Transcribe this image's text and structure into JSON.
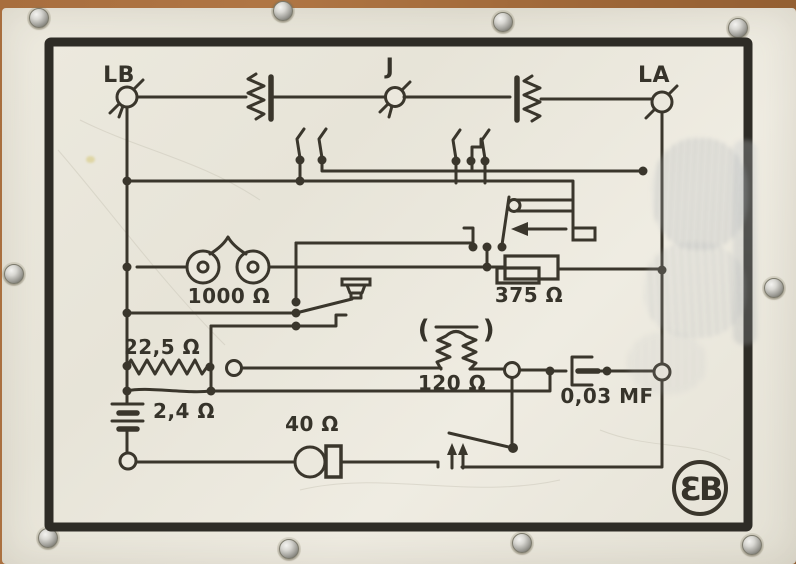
{
  "labels": {
    "terminal_lb": "LB",
    "terminal_j": "J",
    "terminal_la": "LA",
    "ringer_1000": "1000 Ω",
    "resistor_375": "375 Ω",
    "resistor_22_5": "22,5 Ω",
    "battery_2_4": "2,4 Ω",
    "microphone_40": "40 Ω",
    "coil_120": "120 Ω",
    "capacitor_0_03": "0,03 MF",
    "coil_paren_left": "(",
    "coil_paren_right": ")",
    "logo": "ƐB"
  },
  "colors": {
    "plate": "#e8e5da",
    "ink": "#3a362c",
    "frame": "#2e2c26",
    "backing": "#a86e3e",
    "screw": "#c9c8c3"
  }
}
